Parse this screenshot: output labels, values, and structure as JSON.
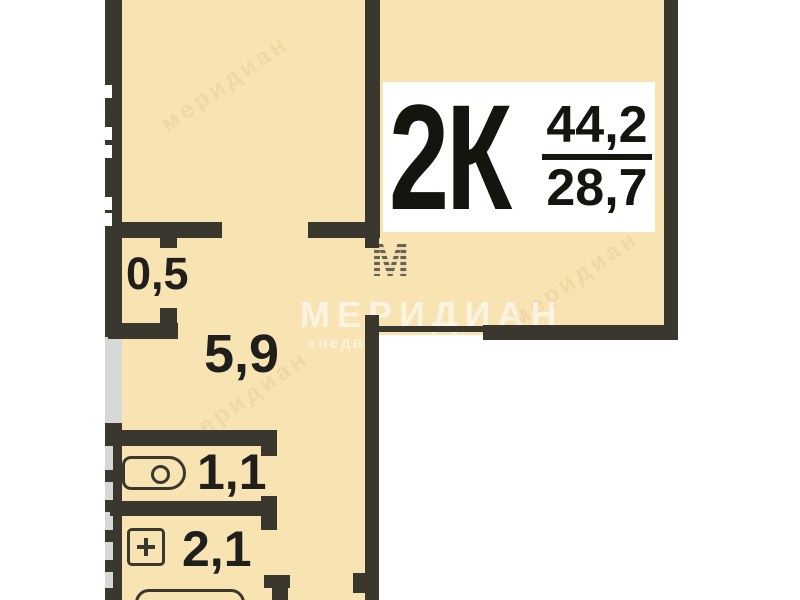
{
  "plan": {
    "unit": {
      "type_label": "2К",
      "area_total": "44,2",
      "area_living": "28,7"
    },
    "rooms": {
      "storage": {
        "label": "0,5"
      },
      "hallway": {
        "label": "5,9"
      },
      "wc": {
        "label": "1,1"
      },
      "bathroom": {
        "label": "2,1"
      }
    },
    "fixtures": [
      "toilet-icon",
      "sink-icon",
      "bathtub-icon"
    ],
    "watermark": {
      "logo_letter": "М",
      "brand": "МЕРИДИАН",
      "brand_subtext": "«недв",
      "diagonal_text": "меридиан"
    },
    "colors": {
      "room_fill": "#f8e3b2",
      "wall": "#3a372f",
      "light_wall_segment": "#d8d8d6",
      "label_box_bg": "#ffffff",
      "label_text": "#15140f"
    }
  }
}
